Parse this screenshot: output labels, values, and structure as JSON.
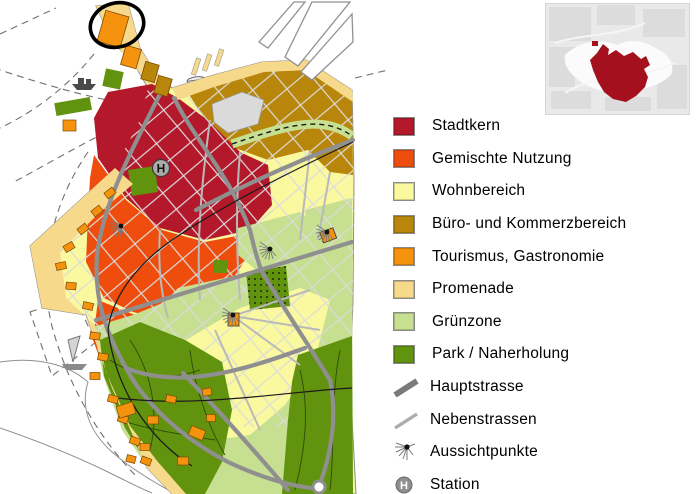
{
  "legend": {
    "items": [
      {
        "label": "Stadtkern",
        "color": "#B4182B",
        "icon": "swatch"
      },
      {
        "label": "Gemischte Nutzung",
        "color": "#EE4D0E",
        "icon": "swatch"
      },
      {
        "label": "Wohnbereich",
        "color": "#FAF9A0",
        "icon": "swatch"
      },
      {
        "label": "Büro- und Kommerzbereich",
        "color": "#B8860B",
        "icon": "swatch"
      },
      {
        "label": "Tourismus, Gastronomie",
        "color": "#F5930F",
        "icon": "swatch"
      },
      {
        "label": "Promenade",
        "color": "#F7D98C",
        "icon": "swatch"
      },
      {
        "label": "Grünzone",
        "color": "#C6DF90",
        "icon": "swatch"
      },
      {
        "label": "Park / Naherholung",
        "color": "#61930F",
        "icon": "swatch"
      },
      {
        "label": "Hauptstrasse",
        "color": "#7A7A7A",
        "icon": "thick-line"
      },
      {
        "label": "Nebenstrassen",
        "color": "#ACACAC",
        "icon": "thin-line"
      },
      {
        "label": "Aussichtpunkte",
        "color": "#777777",
        "icon": "viewpoint"
      },
      {
        "label": "Station",
        "color": "#8F8F8F",
        "icon": "station"
      }
    ]
  },
  "map": {
    "station_label": "H",
    "colors": {
      "water": "#FFFFFF",
      "main_road": "#8F8F8F",
      "minor_road": "#B9B9B9",
      "street": "#DBDBDB",
      "railway": "#1A1A1A",
      "annotation": "#000000"
    }
  },
  "inset": {
    "highlight_color": "#A5101E",
    "background": "#E9E9E9"
  }
}
